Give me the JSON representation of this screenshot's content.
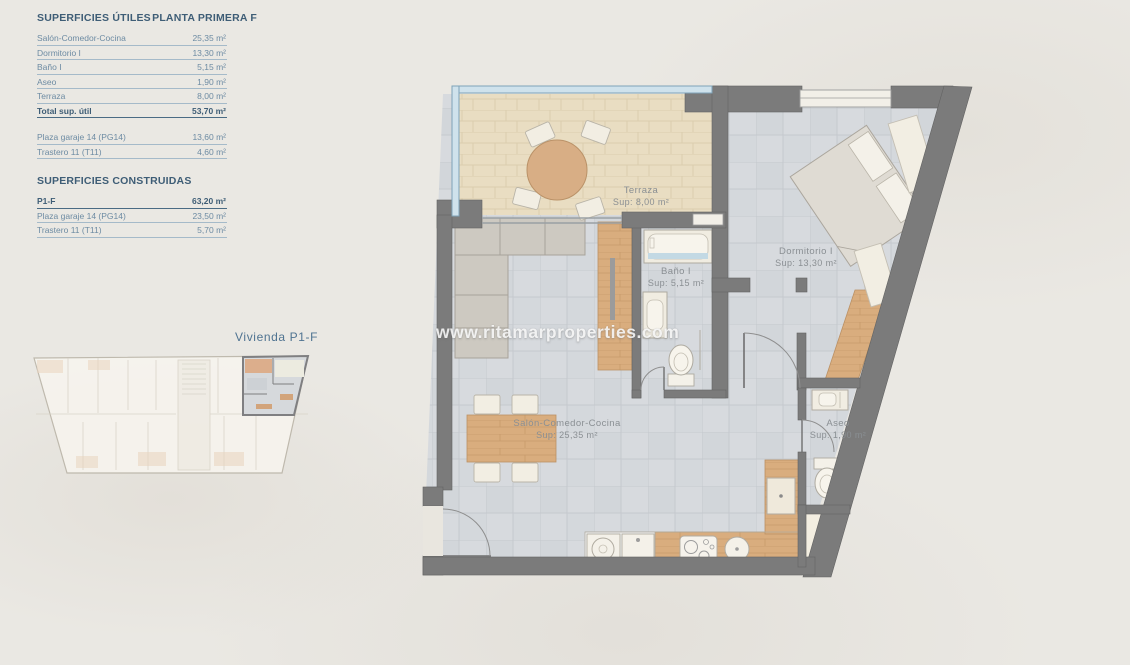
{
  "panel": {
    "title_left": "SUPERFICIES ÚTILES",
    "title_right": "PLANTA PRIMERA F",
    "utiles_rows": [
      {
        "label": "Salón-Comedor-Cocina",
        "value": "25,35 m²"
      },
      {
        "label": "Dormitorio I",
        "value": "13,30 m²"
      },
      {
        "label": "Baño I",
        "value": "5,15 m²"
      },
      {
        "label": "Aseo",
        "value": "1,90 m²"
      },
      {
        "label": "Terraza",
        "value": "8,00 m²"
      },
      {
        "label": "Total sup. útil",
        "value": "53,70 m²",
        "bold": true
      }
    ],
    "utiles_extra_rows": [
      {
        "label": "Plaza garaje 14 (PG14)",
        "value": "13,60 m²"
      },
      {
        "label": "Trastero 11 (T11)",
        "value": "4,60 m²"
      }
    ],
    "construidas_title": "SUPERFICIES CONSTRUIDAS",
    "construidas_rows": [
      {
        "label": "P1-F",
        "value": "63,20 m²",
        "bold": true
      },
      {
        "label": "Plaza garaje 14 (PG14)",
        "value": "23,50 m²"
      },
      {
        "label": "Trastero 11 (T11)",
        "value": "5,70 m²"
      }
    ]
  },
  "overview": {
    "caption": "Vivienda P1-F"
  },
  "watermark": "www.ritamarproperties.com",
  "plan": {
    "rooms": [
      {
        "id": "terraza",
        "name": "Terraza",
        "sup": "Sup: 8,00 m²",
        "x": 641,
        "y": 197
      },
      {
        "id": "dormitorio",
        "name": "Dormitorio I",
        "sup": "Sup: 13,30 m²",
        "x": 806,
        "y": 258
      },
      {
        "id": "bano",
        "name": "Baño I",
        "sup": "Sup: 5,15 m²",
        "x": 676,
        "y": 278
      },
      {
        "id": "salon",
        "name": "Salón-Comedor-Cocina",
        "sup": "Sup: 25,35 m²",
        "x": 567,
        "y": 430
      },
      {
        "id": "aseo",
        "name": "Aseo",
        "sup": "Sup: 1,90 m²",
        "x": 838,
        "y": 430
      }
    ]
  },
  "colors": {
    "head_color": "#3e5d76",
    "row_color": "#6d8ba3",
    "wall": "#7b7b7b",
    "glass": "#cfe2ec",
    "wood": "#d9ad7e",
    "terrace_floor": "#e9ddc2",
    "tile_floor": "#d7dade",
    "label_gray": "#8a8f93"
  }
}
